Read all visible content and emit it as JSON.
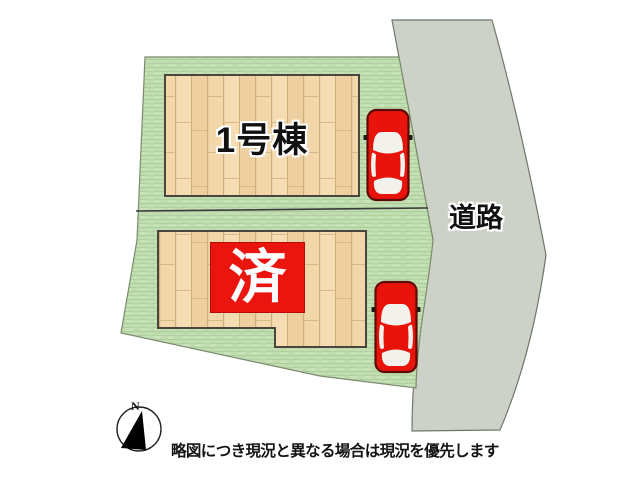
{
  "plan": {
    "building1_label": "1号棟",
    "sold_label": "済",
    "road_label": "道路",
    "compass_north": "N",
    "disclaimer": "略図につき現況と異なる場合は現況を優先します"
  },
  "colors": {
    "grass": "#bedcae",
    "wood": "#f2d7aa",
    "road": "#cdd2c8",
    "car": "#e8140c",
    "sold": "#e9150e"
  }
}
